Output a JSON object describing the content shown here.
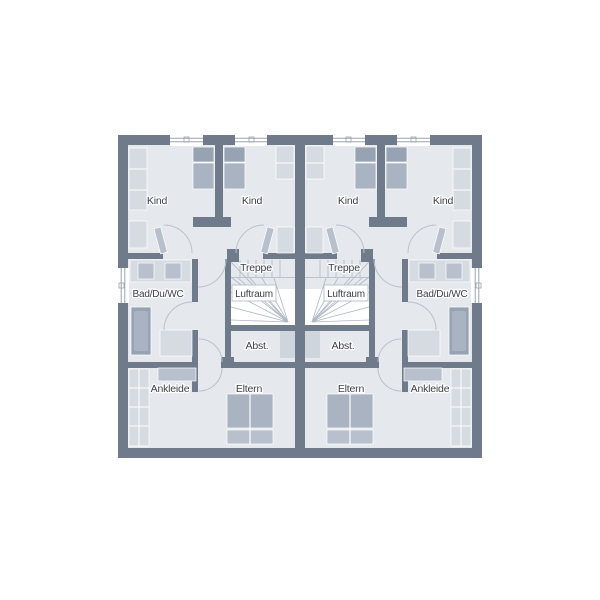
{
  "title": "Obergeschoss Grundriss Doppelhaus",
  "colors": {
    "background": "#ffffff",
    "wall": "#6f7b8b",
    "floor": "#e5e9ee",
    "furniture": "#b7c0cc",
    "furniture_light": "#d6dbe2",
    "fixture": "#cfd5dd",
    "bed_dark": "#97a2b3",
    "bed": "#a9b3c1",
    "tread": "#aeb7c3",
    "arc": "#b9c1cc",
    "window_line": "#9aa3b0",
    "text": "#3d4149"
  },
  "units": [
    {
      "side": "left",
      "rooms": {
        "child_room_1": "Kind",
        "child_room_2": "Kind",
        "stairs": "Treppe",
        "air_space": "Luftraum",
        "bathroom": "Bad/Du/WC",
        "storage": "Abst.",
        "dressing": "Ankleide",
        "parents": "Eltern"
      }
    },
    {
      "side": "right",
      "rooms": {
        "child_room_1": "Kind",
        "child_room_2": "Kind",
        "stairs": "Treppe",
        "air_space": "Luftraum",
        "bathroom": "Bad/Du/WC",
        "storage": "Abst.",
        "dressing": "Ankleide",
        "parents": "Eltern"
      }
    }
  ]
}
